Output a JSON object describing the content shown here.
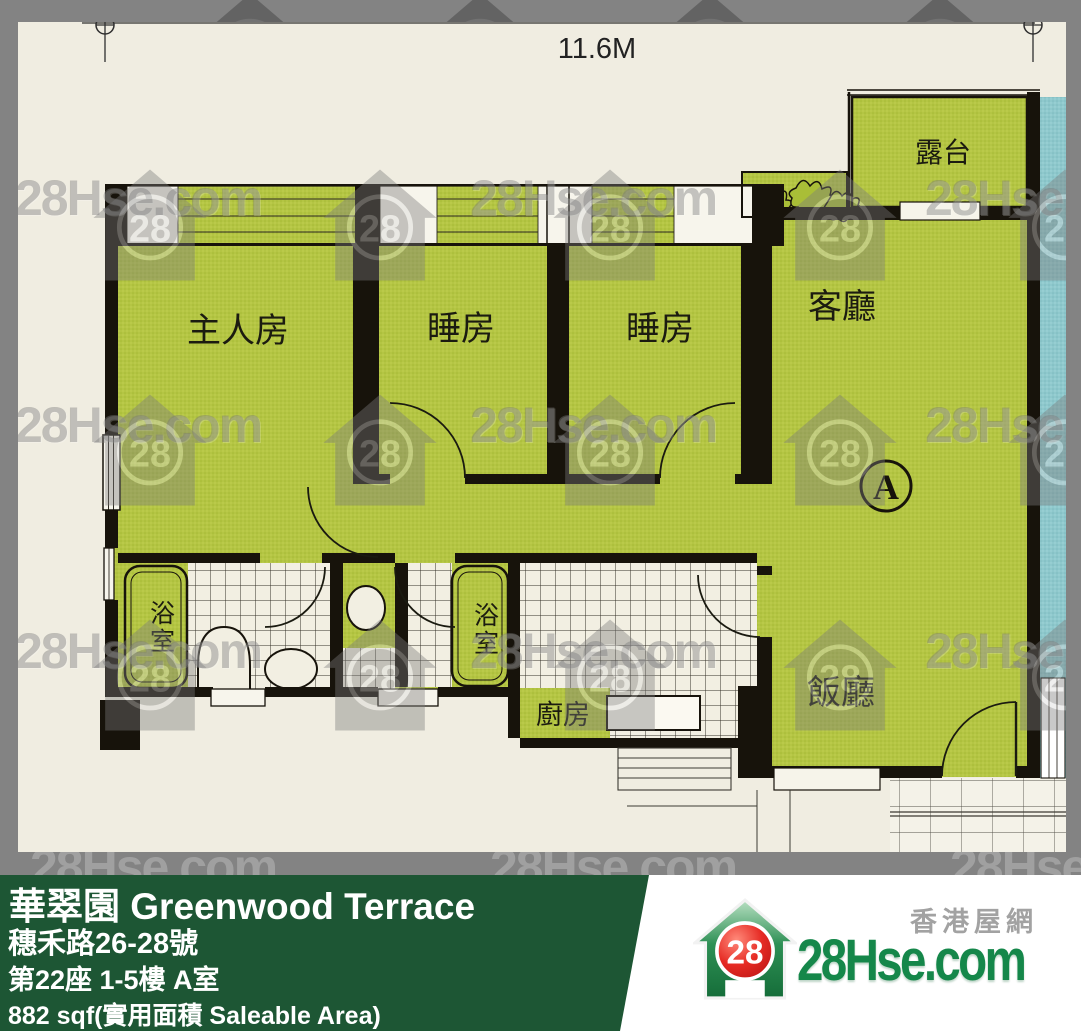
{
  "page": {
    "bg_color": "#838383"
  },
  "plan": {
    "bg_color": "#f0ede1",
    "dimension_label": "11.6M",
    "unit_marker": "A",
    "rooms": {
      "master_bedroom": "主人房",
      "bedroom_1": "睡房",
      "bedroom_2": "睡房",
      "living_room": "客廳",
      "dining_room": "飯廳",
      "balcony": "露台",
      "bathroom_1": "浴室",
      "bathroom_2": "浴室",
      "kitchen": "廚房"
    },
    "colors": {
      "room_fill": "#b4c544",
      "adjacent_unit_fill": "#8ec8cc",
      "wall": "#17130b"
    }
  },
  "watermark": {
    "text": "28Hse.com",
    "logo_number": "28"
  },
  "banner": {
    "bg_color": "#1d5634",
    "title": "華翠園 Greenwood Terrace",
    "address": "穗禾路26-28號",
    "block_floor": "第22座 1-5樓 A室",
    "area": "882 sqf(實用面積 Saleable Area)"
  },
  "site_logo": {
    "number": "28",
    "name": "28Hse.com",
    "tagline": "香港屋網"
  }
}
